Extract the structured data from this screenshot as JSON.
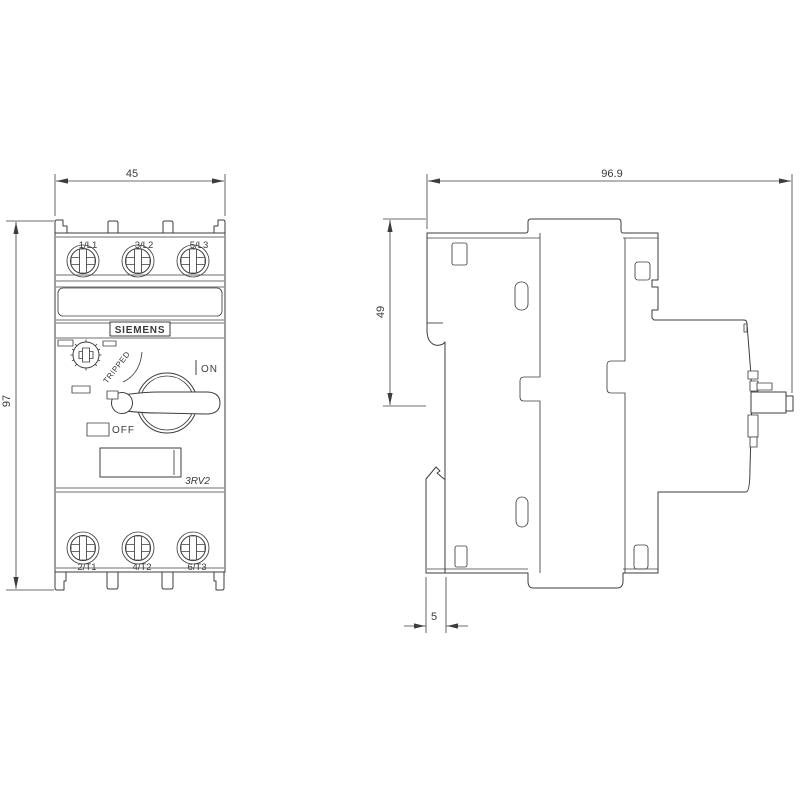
{
  "labels": {
    "brand": "SIEMENS",
    "model": "3RV2",
    "tripped": "TRIPPED",
    "on": "ON",
    "off": "OFF",
    "terminals_top": [
      "1/L1",
      "3/L2",
      "5/L3"
    ],
    "terminals_bottom": [
      "2/T1",
      "4/T2",
      "6/T3"
    ]
  },
  "dimensions": {
    "front_width_mm": "45",
    "front_height_mm": "97",
    "side_depth_mm": "96.9",
    "din_height_mm": "49",
    "din_depth_mm": "5"
  },
  "colors": {
    "line": "#3d3d3d",
    "background": "#ffffff"
  }
}
